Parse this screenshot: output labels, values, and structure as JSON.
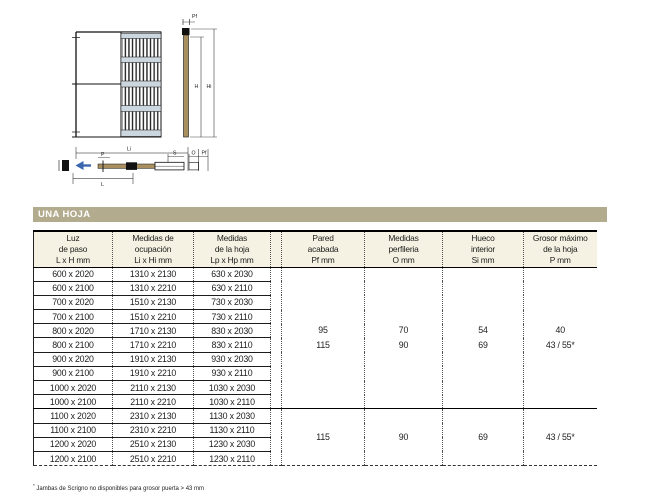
{
  "section_header": {
    "label": "UNA HOJA"
  },
  "colors": {
    "bar_bg": "#b3ab8d",
    "bar_text": "#ffffff",
    "header_bg": "#f6f2e3",
    "line": "#1c1c1c",
    "cassette_band": "#ccd6de",
    "wood": "#a98e5f",
    "arrow": "#3a66b0"
  },
  "diagram": {
    "labels": {
      "pf_top": "Pf",
      "h": "H",
      "hi": "Hi",
      "li": "Li",
      "p": "P",
      "s": "S",
      "o": "O",
      "pf": "Pf",
      "l": "L"
    }
  },
  "table": {
    "columns": [
      {
        "id": "luz",
        "lines": [
          "Luz",
          "de paso",
          "L x H mm"
        ]
      },
      {
        "id": "ocupacion",
        "lines": [
          "Medidas de",
          "ocupación",
          "Li x Hi mm"
        ]
      },
      {
        "id": "hoja",
        "lines": [
          "Medidas",
          "de la hoja",
          "Lp x Hp mm"
        ]
      },
      {
        "id": "spacer",
        "lines": []
      },
      {
        "id": "pared",
        "lines": [
          "Pared",
          "acabada",
          "Pf mm"
        ]
      },
      {
        "id": "perfileria",
        "lines": [
          "Medidas",
          "perfileria",
          "O mm"
        ]
      },
      {
        "id": "hueco",
        "lines": [
          "Hueco",
          "interior",
          "Si mm"
        ]
      },
      {
        "id": "grosor",
        "lines": [
          "Grosor máximo",
          "de la hoja",
          "P mm"
        ]
      }
    ],
    "groups": [
      {
        "rows": [
          [
            "600 x 2020",
            "1310 x 2130",
            "630 x 2030"
          ],
          [
            "600 x 2100",
            "1310 x 2210",
            "630 x 2110"
          ],
          [
            "700 x 2020",
            "1510 x 2130",
            "730 x 2030"
          ],
          [
            "700 x 2100",
            "1510 x 2210",
            "730 x 2110"
          ],
          [
            "800 x 2020",
            "1710 x 2130",
            "830 x 2030"
          ],
          [
            "800 x 2100",
            "1710 x 2210",
            "830 x 2110"
          ],
          [
            "900 x 2020",
            "1910 x 2130",
            "930 x 2030"
          ],
          [
            "900 x 2100",
            "1910 x 2210",
            "930 x 2110"
          ],
          [
            "1000 x 2020",
            "2110 x 2130",
            "1030 x 2030"
          ],
          [
            "1000 x 2100",
            "2110 x 2210",
            "1030 x 2110"
          ]
        ],
        "merged": [
          {
            "lines": [
              "95",
              "115"
            ]
          },
          {
            "lines": [
              "70",
              "90"
            ]
          },
          {
            "lines": [
              "54",
              "69"
            ]
          },
          {
            "lines": [
              "40",
              "43 / 55*"
            ]
          }
        ]
      },
      {
        "rows": [
          [
            "1100 x 2020",
            "2310 x 2130",
            "1130 x 2030"
          ],
          [
            "1100 x 2100",
            "2310 x 2210",
            "1130 x 2110"
          ],
          [
            "1200 x 2020",
            "2510 x 2130",
            "1230 x 2030"
          ],
          [
            "1200 x 2100",
            "2510 x 2210",
            "1230 x 2110"
          ]
        ],
        "merged": [
          {
            "lines": [
              "115"
            ]
          },
          {
            "lines": [
              "90"
            ]
          },
          {
            "lines": [
              "69"
            ]
          },
          {
            "lines": [
              "43 / 55*"
            ]
          }
        ]
      }
    ]
  },
  "footnote": {
    "marker": "*",
    "text": " Jambas de Scrigno no disponibles para grosor puerta > 43 mm"
  }
}
